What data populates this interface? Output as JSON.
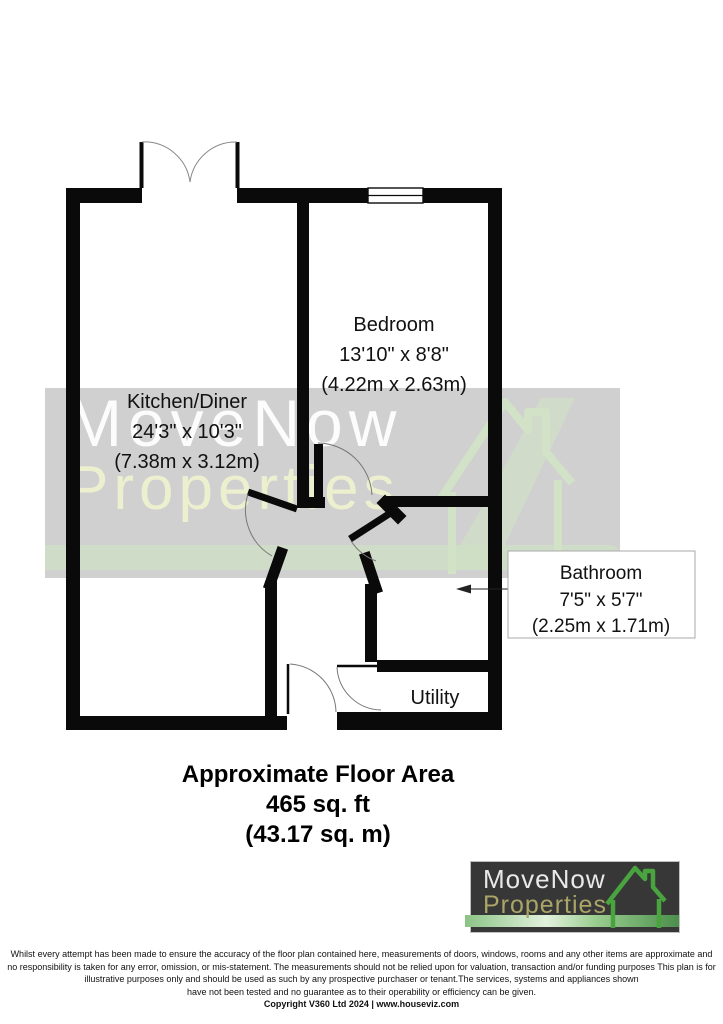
{
  "plan": {
    "rooms": [
      {
        "name": "Kitchen/Diner",
        "dims_imperial": "24'3\" x 10'3\"",
        "dims_metric": "(7.38m x 3.12m)"
      },
      {
        "name": "Bedroom",
        "dims_imperial": "13'10\" x 8'8\"",
        "dims_metric": "(4.22m x 2.63m)"
      },
      {
        "name": "Bathroom",
        "dims_imperial": "7'5\" x 5'7\"",
        "dims_metric": "(2.25m x 1.71m)"
      },
      {
        "name": "Utility"
      }
    ]
  },
  "area": {
    "line1": "Approximate Floor Area",
    "line2": "465 sq. ft",
    "line3": "(43.17 sq. m)"
  },
  "watermark": {
    "line1": "MoveNow",
    "line2": "Properties"
  },
  "logo": {
    "line1": "MoveNow",
    "line2": "Properties"
  },
  "disclaimer": {
    "line1": "Whilst every attempt has been made to ensure the accuracy of the floor plan contained here, measurements of doors, windows, rooms and any other items are approximate and",
    "line2": "no responsibility is taken for any error, omission, or mis-statement.  The measurements should not be relied upon for valuation, transaction and/or funding purposes This plan is for",
    "line3": "illustrative purposes only and should be used as such by any prospective purchaser or tenant.The services, systems and appliances shown",
    "line4": "have not been tested and no guarantee as to their operability or efficiency can be given.",
    "line5": "Copyright V360 Ltd 2024 | www.houseviz.com"
  },
  "colors": {
    "wall": "#0a0a0a",
    "arc": "#808080",
    "watermark_band": "#c9c9c9",
    "watermark_green": "#cfe0c4",
    "logo_bg": "#373737",
    "logo_text": "#e9e9e9",
    "logo_accent": "#aaa566",
    "logo_house_green": "#49a33f"
  }
}
